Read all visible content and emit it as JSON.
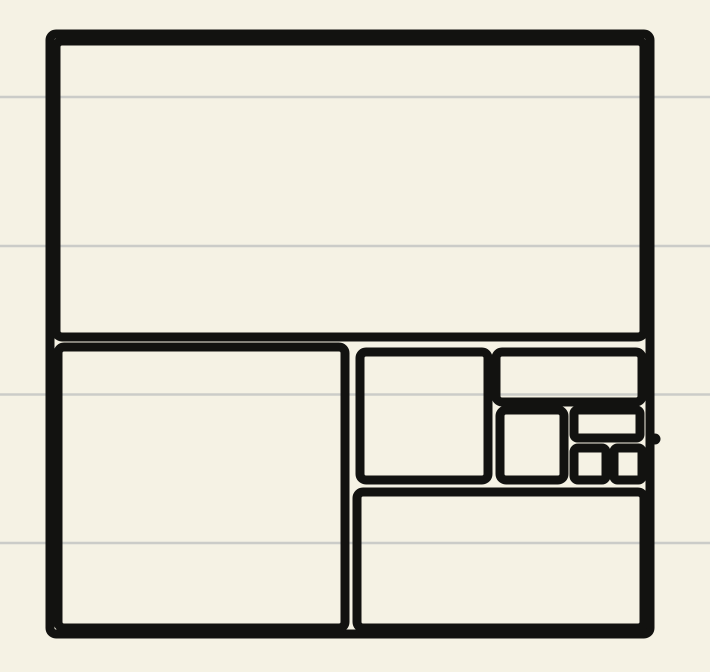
{
  "app": {
    "description": "golden-ratio rectangle subdivision sketch on ruled note paper"
  },
  "paper": {
    "width": 710,
    "height": 672,
    "background_color": "#f5f2e4",
    "ruled_line_color": "#cbccc8",
    "ruled_line_thickness": 2.4,
    "ruled_lines_y": [
      97,
      246,
      394.5,
      543
    ]
  },
  "drawing": {
    "stroke_color": "#121210",
    "stroke_width": 9,
    "corner_radius": 6,
    "shapes": [
      {
        "name": "outer-square",
        "type": "rect",
        "x": 50,
        "y": 34,
        "w": 600,
        "h": 600
      },
      {
        "name": "top-rectangle",
        "type": "rect",
        "x": 56,
        "y": 41,
        "w": 588,
        "h": 296
      },
      {
        "name": "bottom-left-square",
        "type": "rect",
        "x": 58,
        "y": 347,
        "w": 287,
        "h": 281
      },
      {
        "name": "middle-square",
        "type": "rect",
        "x": 360,
        "y": 352,
        "w": 128,
        "h": 128
      },
      {
        "name": "upper-right-rectangle",
        "type": "rect",
        "x": 496,
        "y": 352,
        "w": 146,
        "h": 50
      },
      {
        "name": "inner-square-b",
        "type": "rect",
        "x": 500,
        "y": 410,
        "w": 64,
        "h": 70
      },
      {
        "name": "small-top-rectangle",
        "type": "rect",
        "x": 574,
        "y": 410,
        "w": 66,
        "h": 28
      },
      {
        "name": "small-square-c",
        "type": "rect",
        "x": 574,
        "y": 448,
        "w": 32,
        "h": 32
      },
      {
        "name": "small-square-d",
        "type": "rect",
        "x": 614,
        "y": 448,
        "w": 28,
        "h": 32
      },
      {
        "name": "bottom-right-rectangle",
        "type": "rect",
        "x": 357,
        "y": 492,
        "w": 287,
        "h": 136
      },
      {
        "name": "stroke-endpoint-dot",
        "type": "circle",
        "cx": 655,
        "cy": 439,
        "r": 5.5
      }
    ]
  }
}
